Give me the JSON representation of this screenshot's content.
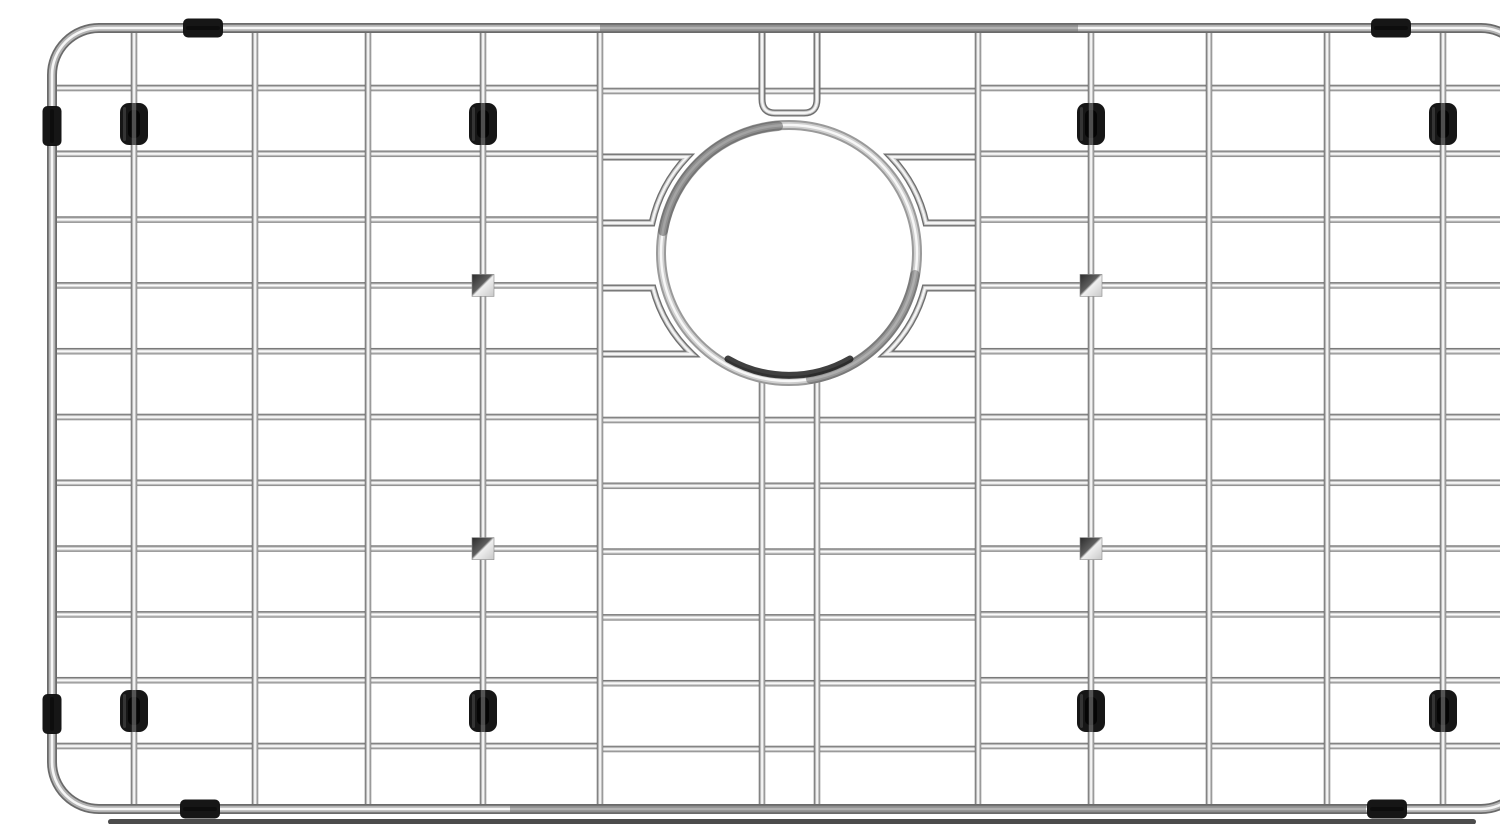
{
  "scene": {
    "width": 1500,
    "height": 808,
    "background": "#ffffff",
    "description": "Stainless steel kitchen sink bottom grid protector with circular rear drain opening, chrome wire lattice, black rubber feet and edge bumpers, photographed on a white background"
  },
  "palette": {
    "wire_gradient_stops": [
      [
        "0%",
        "#5f5f5f"
      ],
      [
        "20%",
        "#9e9e9e"
      ],
      [
        "42%",
        "#f4f4f4"
      ],
      [
        "55%",
        "#ffffff"
      ],
      [
        "75%",
        "#bdbdbd"
      ],
      [
        "100%",
        "#7d7d7d"
      ]
    ],
    "square_gradient_stops": [
      [
        "0%",
        "#2b2b2b"
      ],
      [
        "45%",
        "#5f5f5f"
      ],
      [
        "52%",
        "#efefef"
      ],
      [
        "100%",
        "#c8c8c8"
      ]
    ],
    "frame_tube_layers": [
      [
        "#6a6a6a",
        10
      ],
      [
        "#b3b3b3",
        6.5
      ],
      [
        "#f6f6f6",
        2.6
      ]
    ],
    "thin_tube_layers": [
      [
        "#6f6f6f",
        7
      ],
      [
        "#c9c9c9",
        4.2
      ],
      [
        "#f5f5f5",
        2.0
      ]
    ],
    "ring_layers": [
      [
        "#9a9a9a",
        10
      ],
      [
        "#cfcfcf",
        6
      ],
      [
        "#f7f7f7",
        2.4
      ]
    ],
    "frame_dark_overlay": "#6a6a6a",
    "rubber_black": "#161616",
    "rubber_slot": "#050505",
    "rubber_wire_stripe": "#8a8a8a",
    "shadow_color": "#383838",
    "square_stroke": "#8a8a8a"
  },
  "frame": {
    "x": 12,
    "y": 12,
    "w": 1476,
    "h": 781,
    "rx": 47,
    "dark_segments": [
      {
        "x1": 560,
        "x2": 1038,
        "y": 12
      },
      {
        "x1": 470,
        "x2": 1326,
        "y": 793
      }
    ],
    "shadow": {
      "x": 68,
      "y": 803,
      "w": 1368,
      "h": 5.5,
      "rx": 2.75
    }
  },
  "grid": {
    "wire_w": 6.5,
    "top": 12,
    "bottom": 793,
    "left": 12,
    "right": 1488,
    "rows_full": [
      72,
      401,
      466.8,
      532.6,
      598.4,
      664.2,
      730
    ],
    "rows_split": [
      137.8,
      203.6,
      269.4,
      335.2
    ],
    "sections": {
      "left_x1": 12,
      "left_x2": 562,
      "center_x1": 557,
      "center_x2": 941,
      "right_x1": 936,
      "right_x2": 1488,
      "center_dy": 3
    },
    "verticals": [
      94,
      215,
      328,
      443,
      560,
      938,
      1051,
      1169,
      1287,
      1403
    ],
    "pair": {
      "x_left": 722,
      "x_right": 777,
      "u_path": "M722 12V83Q722 97 735 97H764Q777 97 777 83V12",
      "lower_y1": 358,
      "lower_y2": 793
    }
  },
  "drain": {
    "cx": 749,
    "cy": 237,
    "r": 128,
    "dark_arcs": [
      {
        "d": "M738 110A128 128 0 0 0 623 215",
        "w": 10,
        "color": "#4f4f4f",
        "opacity": 0.5
      },
      {
        "d": "M875 259A128 128 0 0 1 771 363",
        "w": 10,
        "color": "#555555",
        "opacity": 0.45
      },
      {
        "d": "M688 343A122 122 0 0 0 810 343",
        "w": 7,
        "color": "#1f1f1f",
        "opacity": 0.85
      }
    ],
    "hairpins": [
      "M557 141H647A140 140 0 0 0 612 207H557",
      "M557 272H613A140 140 0 0 0 652 338H557",
      "M941 141H851A140 140 0 0 1 886 207H941",
      "M941 272H885A140 140 0 0 1 846 338H941"
    ]
  },
  "weld_squares": {
    "size": 22,
    "centers": [
      [
        443,
        269.4
      ],
      [
        1051,
        269.4
      ],
      [
        443,
        532.6
      ],
      [
        1051,
        532.6
      ]
    ]
  },
  "rubber_feet": {
    "w": 28,
    "h": 42,
    "rx": 9,
    "centers": [
      [
        94,
        108
      ],
      [
        443,
        108
      ],
      [
        1051,
        108
      ],
      [
        1403,
        108
      ],
      [
        94,
        695
      ],
      [
        443,
        695
      ],
      [
        1051,
        695
      ],
      [
        1403,
        695
      ]
    ]
  },
  "edge_bumpers": {
    "long": 40,
    "thick": 19,
    "rx": 5,
    "items": [
      {
        "x": 163,
        "y": 12,
        "o": "h"
      },
      {
        "x": 1351,
        "y": 12,
        "o": "h"
      },
      {
        "x": 160,
        "y": 793,
        "o": "h"
      },
      {
        "x": 1347,
        "y": 793,
        "o": "h"
      },
      {
        "x": 12,
        "y": 110,
        "o": "v"
      },
      {
        "x": 12,
        "y": 698,
        "o": "v"
      },
      {
        "x": 1488,
        "y": 110,
        "o": "v"
      },
      {
        "x": 1488,
        "y": 698,
        "o": "v"
      }
    ]
  }
}
